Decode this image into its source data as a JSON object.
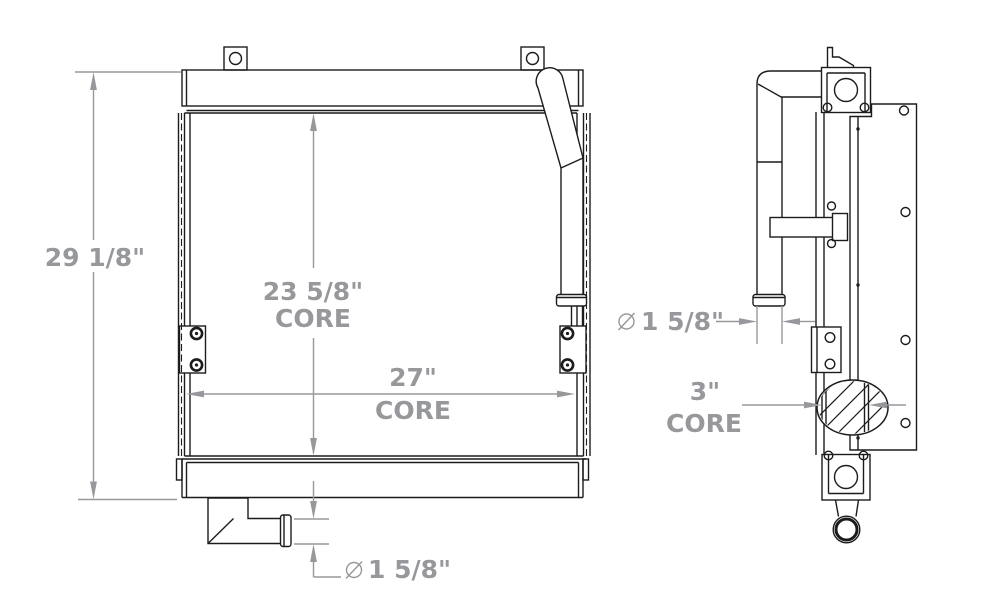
{
  "colors": {
    "line": "#1c1c1c",
    "dimension": "#97989b",
    "background": "#ffffff"
  },
  "front_view": {
    "overall_height": "29 1/8\"",
    "core_height": "23 5/8\"",
    "core_height_label": "CORE",
    "core_width": "27\"",
    "core_width_label": "CORE",
    "outlet_diameter": "1 5/8\"",
    "outlet_diameter_symbol": "⌀"
  },
  "side_view": {
    "pipe_diameter": "1 5/8\"",
    "pipe_diameter_symbol": "⌀",
    "core_depth": "3\"",
    "core_depth_label": "CORE"
  }
}
